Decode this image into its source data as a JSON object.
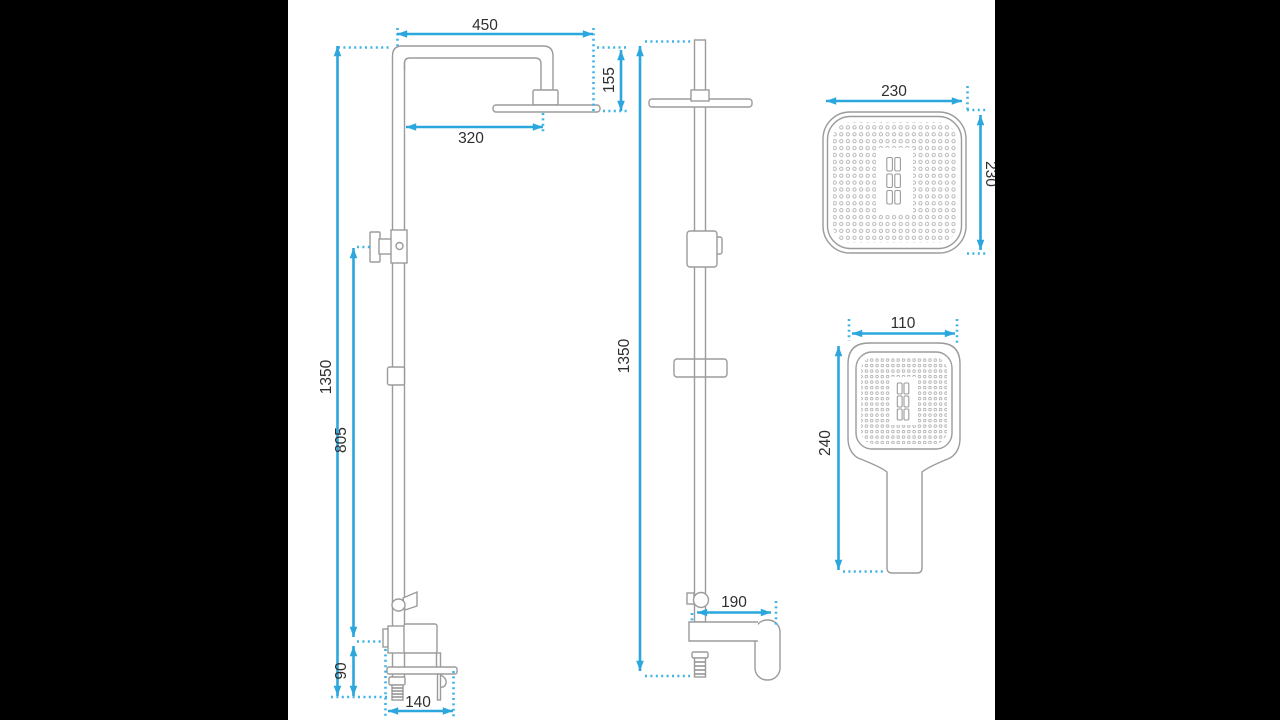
{
  "drawing_title": "shower-column-technical-drawing",
  "views": {
    "front": {
      "dims": {
        "arm_width": "450",
        "head_offset": "320",
        "head_drop": "155",
        "total_height": "1350",
        "slider_height": "805",
        "inlet_drop": "90",
        "inlet_width": "140"
      }
    },
    "side": {
      "dims": {
        "total_height": "1350",
        "spout_reach": "190"
      }
    },
    "head_detail": {
      "dims": {
        "width": "230",
        "height": "230"
      }
    },
    "hand_shower_detail": {
      "dims": {
        "width": "110",
        "length": "240"
      }
    }
  },
  "colors": {
    "dimension_blue": "#2BA7DE",
    "dotted_cyan": "#3DB3E6",
    "outline_gray": "#9B9B9B",
    "label_dark": "#2F2F2F",
    "canvas_white": "#FFFFFF",
    "letterbox_black": "#000000"
  }
}
